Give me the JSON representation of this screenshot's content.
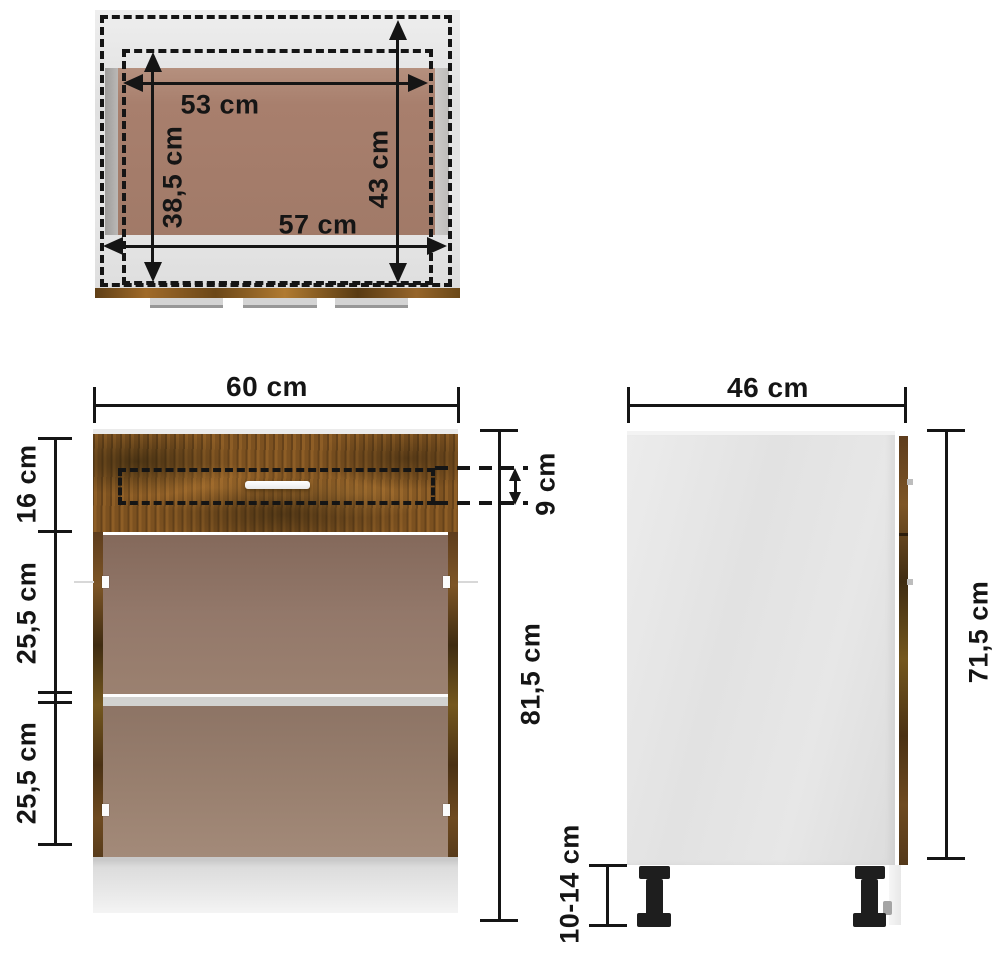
{
  "dimensions": {
    "top_view": {
      "inner_width": "53 cm",
      "inner_depth": "38,5 cm",
      "outer_depth": "43 cm",
      "outer_width": "57 cm"
    },
    "front_view": {
      "width": "60 cm",
      "drawer_front_height": "16 cm",
      "drawer_slot_height": "9 cm",
      "upper_section_height": "25,5 cm",
      "lower_section_height": "25,5 cm",
      "total_height": "81,5 cm"
    },
    "side_view": {
      "depth": "46 cm",
      "carcass_height": "71,5 cm",
      "legs_height": "10-14 cm"
    }
  },
  "colors": {
    "ink": "#151515",
    "body-gray": "#e4e4e4",
    "brown-top": "#a87f6d",
    "brown-front": "#8d7365",
    "shelf": "#d2d2d0",
    "leg": "#1e1e1e"
  }
}
